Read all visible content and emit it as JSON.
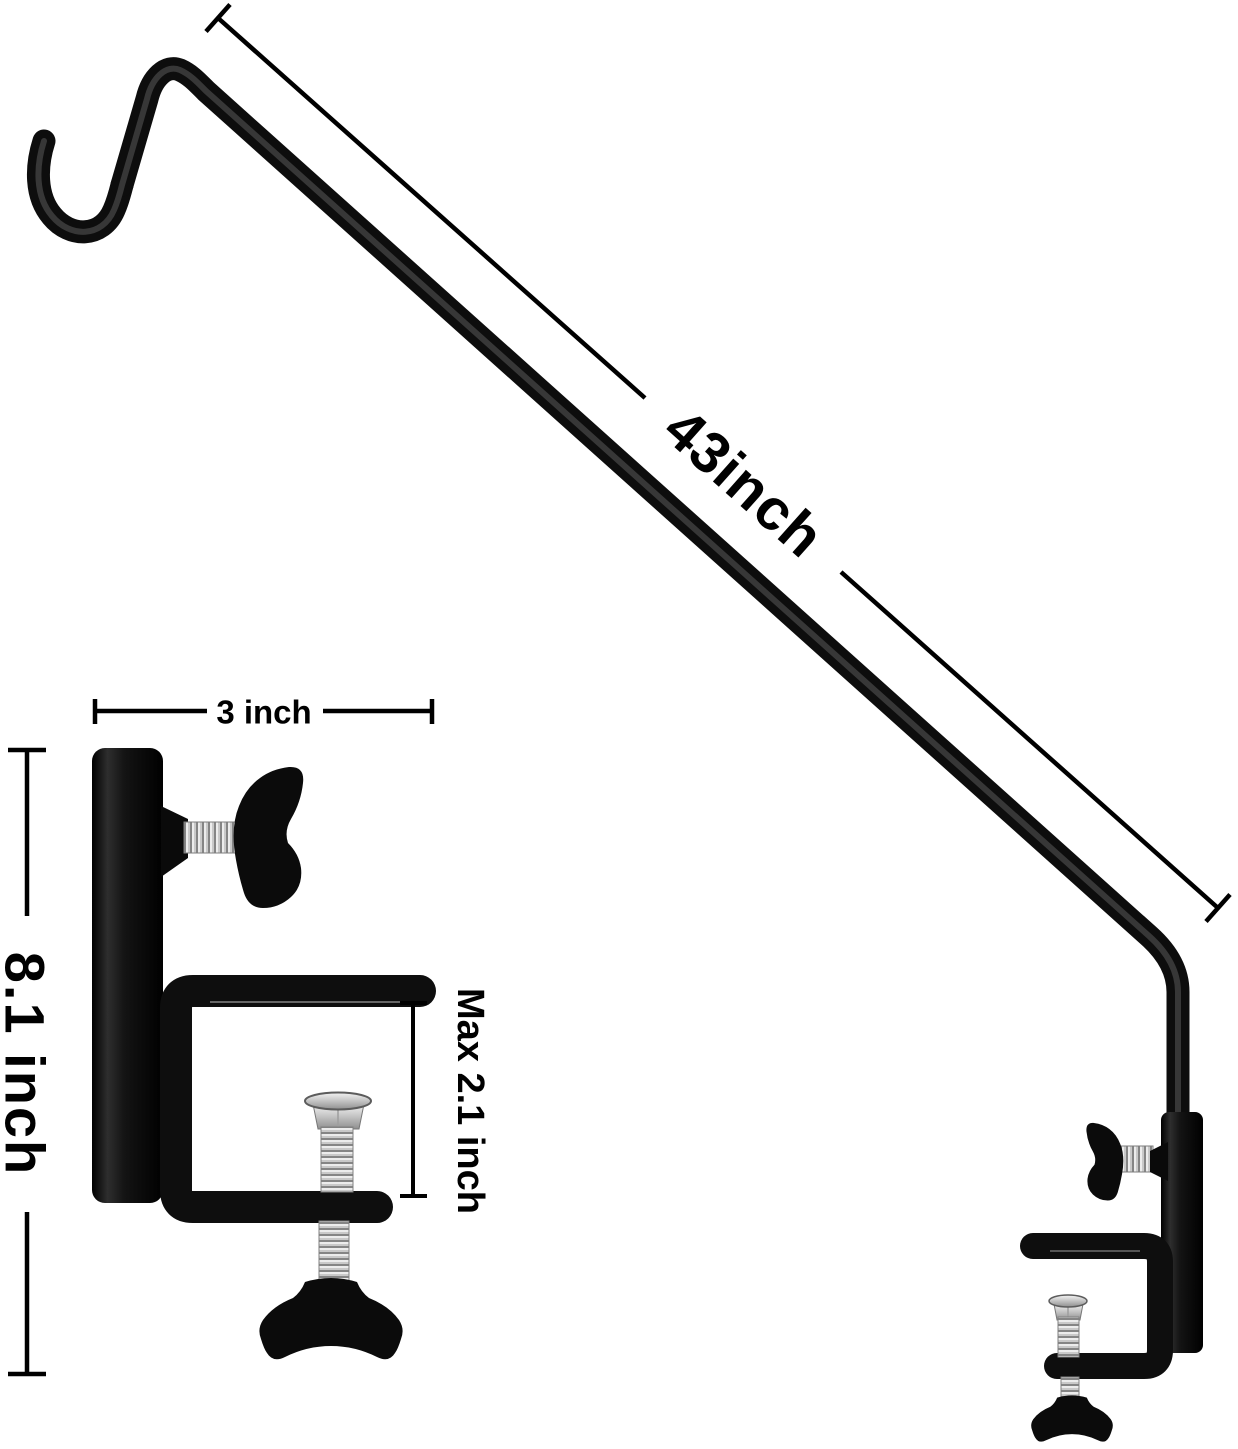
{
  "figure": {
    "type": "product-dimension-diagram",
    "background": "#ffffff",
    "colors": {
      "ink": "#000000",
      "steel_black": "#0d0d0d",
      "metal_light": "#d2d2d2",
      "metal_dark": "#8a8a8a"
    },
    "labels": {
      "pole_length": "43inch",
      "clamp_width": "3 inch",
      "bracket_height": "8.1 inch",
      "clamp_opening": "Max 2.1 inch"
    }
  }
}
